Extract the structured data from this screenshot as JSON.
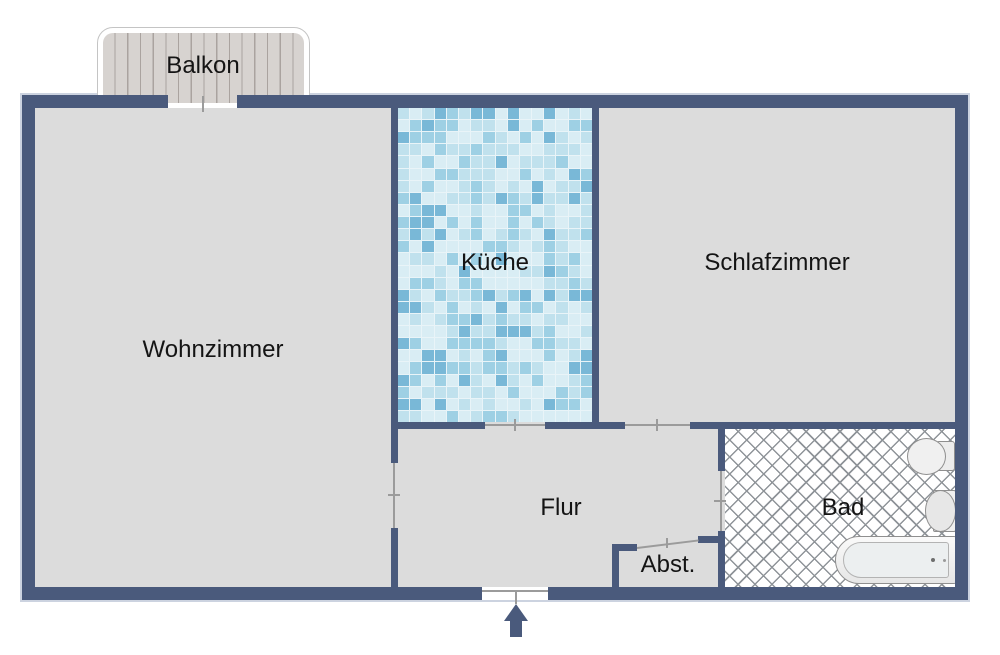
{
  "floorplan": {
    "type": "apartment-floor-plan",
    "rooms": [
      {
        "name": "balkon",
        "label": "Balkon"
      },
      {
        "name": "wohnzimmer",
        "label": "Wohnzimmer"
      },
      {
        "name": "kueche",
        "label": "Küche"
      },
      {
        "name": "schlafzimmer",
        "label": "Schlafzimmer"
      },
      {
        "name": "flur",
        "label": "Flur"
      },
      {
        "name": "abstellraum",
        "label": "Abst."
      },
      {
        "name": "bad",
        "label": "Bad"
      }
    ],
    "colors": {
      "wall": "#4a5a7c",
      "floor": "#dcdcdc",
      "grout": "#e9f4f8",
      "balcony-plank": "#d7d3d0",
      "balcony-plank-line": "#aaa39f",
      "door-line": "#9b9b9b",
      "lattice-line": "#8f9499",
      "fixture-outline": "#8f8f8f"
    },
    "tile_colors": [
      "#d9edf4",
      "#c0e1ed",
      "#9ed0e4",
      "#79b8d7"
    ]
  }
}
